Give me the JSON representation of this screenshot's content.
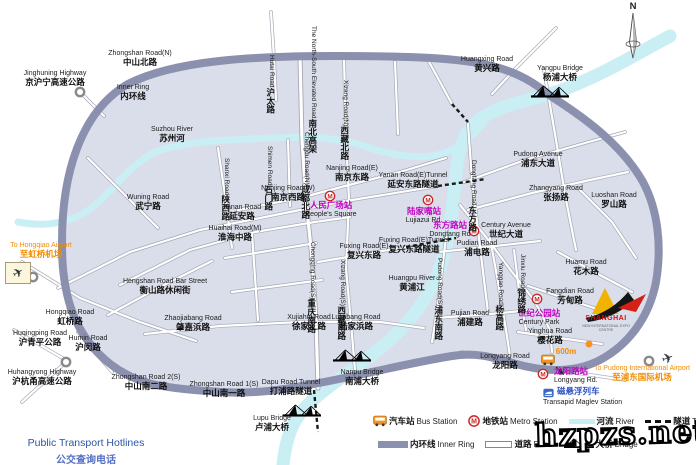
{
  "map": {
    "compass": "N",
    "colors": {
      "inner_ring": "#8b90ae",
      "river": "#c9eef4",
      "map_fill": "#dadeea",
      "station_text": "#c400c4",
      "airport_text": "#f08c00",
      "maglev_text": "#2f55c0",
      "metro_icon": "#c62828",
      "bus_icon": "#f7941d",
      "hotlines_text": "#2b55a8"
    },
    "labels": [
      {
        "id": "lbl-jinghuning-highway",
        "en": "Jinghuning Highway",
        "zh": "京沪宁高速公路",
        "x": 55,
        "y": 70
      },
      {
        "id": "lbl-zhongshan-road-n",
        "en": "Zhongshan Road(N)",
        "zh": "中山北路",
        "x": 140,
        "y": 50
      },
      {
        "id": "lbl-inner-ring",
        "en": "Inner Ring",
        "zh": "内环线",
        "x": 133,
        "y": 84
      },
      {
        "id": "lbl-hutai-road",
        "en": "Hutai Road",
        "zh": "沪太路",
        "x": 262,
        "y": 55,
        "cls": "v"
      },
      {
        "id": "lbl-north-south-elevated",
        "en": "The North-South Elevated Road",
        "zh": "南北高架",
        "x": 304,
        "y": 26,
        "cls": "v"
      },
      {
        "id": "lbl-xizang-road-n",
        "en": "Xizang Road(N)",
        "zh": "西藏北路",
        "x": 336,
        "y": 80,
        "cls": "v"
      },
      {
        "id": "lbl-huangxing-road",
        "en": "Huangxing Road",
        "zh": "黄兴路",
        "x": 487,
        "y": 56
      },
      {
        "id": "lbl-yangpu-bridge",
        "en": "Yangpu Bridge",
        "zh": "杨浦大桥",
        "x": 560,
        "y": 65
      },
      {
        "id": "lbl-suzhou-river",
        "en": "Suzhou River",
        "zh": "苏州河",
        "x": 172,
        "y": 126
      },
      {
        "id": "lbl-shimen-road",
        "en": "Shimen Road",
        "zh": "石门路",
        "x": 260,
        "y": 146,
        "cls": "v"
      },
      {
        "id": "lbl-chengdu-road-n",
        "en": "Chengdu Road(N)",
        "zh": "成都北路",
        "x": 297,
        "y": 132,
        "cls": "v"
      },
      {
        "id": "lbl-nanjing-road-e",
        "en": "Nanjing Road(E)",
        "zh": "南京东路",
        "x": 352,
        "y": 165
      },
      {
        "id": "lbl-yanan-road-e-tunnel",
        "en": "Yanan Road(E)Tunnel",
        "zh": "延安东路隧道",
        "x": 413,
        "y": 172
      },
      {
        "id": "lbl-pudong-avenue",
        "en": "Pudong Avenue",
        "zh": "浦东大道",
        "x": 538,
        "y": 151
      },
      {
        "id": "lbl-dongfang-road-v",
        "en": "Dongfang Road",
        "zh": "东方路",
        "x": 464,
        "y": 160,
        "cls": "v"
      },
      {
        "id": "lbl-zhangyang-road",
        "en": "Zhangyang Road",
        "zh": "张扬路",
        "x": 556,
        "y": 185
      },
      {
        "id": "lbl-luoshan-road",
        "en": "Luoshan Road",
        "zh": "罗山路",
        "x": 614,
        "y": 192
      },
      {
        "id": "lbl-wuning-road",
        "en": "Wuning Road",
        "zh": "武宁路",
        "x": 148,
        "y": 194
      },
      {
        "id": "lbl-shanxi-road",
        "en": "Shanxi Road",
        "zh": "陕西路",
        "x": 217,
        "y": 158,
        "cls": "v"
      },
      {
        "id": "lbl-nanjing-road-w",
        "en": "Nanjing Road(W)",
        "zh": "南京西路",
        "x": 288,
        "y": 185
      },
      {
        "id": "lbl-peoples-square",
        "zh": "人民广场站",
        "en": "People's Square",
        "x": 331,
        "y": 201,
        "cls": "station",
        "first": "zh"
      },
      {
        "id": "lbl-lujiazui-station",
        "zh": "陆家嘴站",
        "en": "Lujiazui Rd.",
        "x": 424,
        "y": 207,
        "cls": "station",
        "first": "zh"
      },
      {
        "id": "lbl-dongfang-rd-station",
        "zh": "东方路站",
        "en": "Dongfang Rd",
        "x": 450,
        "y": 221,
        "cls": "station",
        "first": "zh"
      },
      {
        "id": "lbl-century-avenue",
        "en": "Century Avenue",
        "zh": "世纪大道",
        "x": 506,
        "y": 222
      },
      {
        "id": "lbl-yanan-road",
        "en": "Yanan Road",
        "zh": "延安路",
        "x": 242,
        "y": 204
      },
      {
        "id": "lbl-huaihai-road-m",
        "en": "Huaihai Road(M)",
        "zh": "淮海中路",
        "x": 235,
        "y": 225
      },
      {
        "id": "lbl-to-hongqiao-airport",
        "en": "To Hongqiao Airport",
        "zh": "至虹桥机场",
        "x": 41,
        "y": 242,
        "cls": "airport"
      },
      {
        "id": "lbl-hengshan-road-bar-street",
        "en": "Hengshan Road Bar Street",
        "zh": "衡山路休闲街",
        "x": 165,
        "y": 278
      },
      {
        "id": "lbl-chongqing-road-s",
        "en": "Chongqing Road(S)",
        "zh": "重庆南路",
        "x": 303,
        "y": 242,
        "cls": "v"
      },
      {
        "id": "lbl-xizang-road-s",
        "en": "Xizang Road(S)",
        "zh": "西藏南路",
        "x": 333,
        "y": 260,
        "cls": "v"
      },
      {
        "id": "lbl-fuxing-road-e",
        "en": "Fuxing Road(E)",
        "zh": "复兴东路",
        "x": 364,
        "y": 243
      },
      {
        "id": "lbl-fuxing-road-e-tunnel",
        "en": "Fuxing Road(E)Tunnel",
        "zh": "复兴东路隧道",
        "x": 414,
        "y": 237
      },
      {
        "id": "lbl-huangpu-river",
        "en": "Huangpu River",
        "zh": "黄浦江",
        "x": 412,
        "y": 275
      },
      {
        "id": "lbl-pudong-road-s",
        "en": "Pudong Road(S)",
        "zh": "浦东南路",
        "x": 430,
        "y": 258,
        "cls": "v"
      },
      {
        "id": "lbl-pudian-road",
        "en": "Pudian Road",
        "zh": "浦电路",
        "x": 477,
        "y": 240
      },
      {
        "id": "lbl-pujian-road",
        "en": "Pujian Road",
        "zh": "浦建路",
        "x": 470,
        "y": 310
      },
      {
        "id": "lbl-hongqiao-road",
        "en": "Hongqiao Road",
        "zh": "虹桥路",
        "x": 70,
        "y": 309
      },
      {
        "id": "lbl-zhaojiabang-road",
        "en": "Zhaojiabang Road",
        "zh": "肇嘉浜路",
        "x": 193,
        "y": 315
      },
      {
        "id": "lbl-xujiahui-road",
        "en": "Xujiahui Road",
        "zh": "徐家汇路",
        "x": 309,
        "y": 314
      },
      {
        "id": "lbl-lujiabang-road",
        "en": "Lujiabang Road",
        "zh": "陆家浜路",
        "x": 356,
        "y": 314
      },
      {
        "id": "lbl-huqingping-road",
        "en": "Huqingping Road",
        "zh": "沪青平公路",
        "x": 40,
        "y": 330
      },
      {
        "id": "lbl-humin-road",
        "en": "Humin Road",
        "zh": "沪闵路",
        "x": 88,
        "y": 335
      },
      {
        "id": "lbl-huhangyong-highway",
        "en": "Huhangyong Highway",
        "zh": "沪杭甬高速公路",
        "x": 42,
        "y": 369
      },
      {
        "id": "lbl-zhongshan-road-2s",
        "en": "Zhongshan Road 2(S)",
        "zh": "中山南二路",
        "x": 146,
        "y": 374
      },
      {
        "id": "lbl-zhongshan-road-1s",
        "en": "Zhongshan Road 1(S)",
        "zh": "中山南一路",
        "x": 224,
        "y": 381
      },
      {
        "id": "lbl-dapu-road-tunnel",
        "en": "Dapu Road Tunnel",
        "zh": "打浦路隧道",
        "x": 291,
        "y": 379
      },
      {
        "id": "lbl-nanpu-bridge",
        "en": "Nanpu Bridge",
        "zh": "南浦大桥",
        "x": 362,
        "y": 369
      },
      {
        "id": "lbl-lupu-bridge",
        "en": "Lupu Bridge",
        "zh": "卢浦大桥",
        "x": 272,
        "y": 415
      },
      {
        "id": "lbl-longyang-road",
        "en": "Longyang Road",
        "zh": "龙阳路",
        "x": 505,
        "y": 353
      },
      {
        "id": "lbl-longyang-rd-station",
        "zh": "龙阳路站",
        "en": "Longyang Rd.",
        "x": 554,
        "y": 367,
        "cls": "station la",
        "first": "zh"
      },
      {
        "id": "lbl-maglev-zh",
        "zh": "磁悬浮列车",
        "x": 557,
        "y": 387,
        "cls": "maglev la"
      },
      {
        "id": "lbl-maglev-en",
        "en": "Transapid Maglev Station",
        "x": 543,
        "y": 399,
        "cls": "la"
      },
      {
        "id": "lbl-to-pudong-airport",
        "en": "To Pudong International Airport",
        "zh": "至浦东国际机场",
        "x": 642,
        "y": 365,
        "cls": "airport"
      },
      {
        "id": "lbl-huamu-road",
        "en": "Huamu Road",
        "zh": "花木路",
        "x": 586,
        "y": 259
      },
      {
        "id": "lbl-fangdian-road",
        "en": "Fangdian Road",
        "zh": "芳甸路",
        "x": 570,
        "y": 288
      },
      {
        "id": "lbl-century-park-station",
        "zh": "世纪公园站",
        "en": "Century Park",
        "x": 539,
        "y": 309,
        "cls": "station",
        "first": "zh"
      },
      {
        "id": "lbl-yinghua-road",
        "en": "Yinghua Road",
        "zh": "樱花路",
        "x": 550,
        "y": 328
      },
      {
        "id": "lbl-yanggao-road",
        "en": "Yanggao Road",
        "zh": "杨高路",
        "x": 491,
        "y": 262,
        "cls": "v"
      },
      {
        "id": "lbl-jinxiu-road",
        "en": "Jinxiu Road",
        "zh": "锦绣路",
        "x": 513,
        "y": 254,
        "cls": "v"
      },
      {
        "id": "lbl-600m",
        "en": "600m",
        "x": 566,
        "y": 348,
        "cls": "m600"
      },
      {
        "id": "lbl-compass-n",
        "en": "N",
        "x": 633,
        "y": 2,
        "cls": "compass"
      },
      {
        "id": "lbl-expo-name",
        "en": "SHANGHAI",
        "x": 606,
        "y": 315,
        "cls": "expo-name"
      },
      {
        "id": "lbl-expo-sub",
        "en": "NEW INTERNATIONAL EXPO CENTRE",
        "x": 606,
        "y": 324,
        "cls": "expo-sub"
      }
    ],
    "legend": {
      "row1": [
        {
          "icon": "bus",
          "zh": "汽车站",
          "en": "Bus Station"
        },
        {
          "icon": "metro",
          "zh": "地铁站",
          "en": "Metro Station"
        },
        {
          "icon": "river",
          "zh": "河流",
          "en": "River"
        },
        {
          "icon": "tunnel",
          "zh": "隧道",
          "en": "Tunnel"
        }
      ],
      "row2": [
        {
          "icon": "ring",
          "zh": "内环线",
          "en": "Inner Ring"
        },
        {
          "icon": "road",
          "zh": "道路",
          "en": "Road"
        },
        {
          "icon": "bridge",
          "zh": "大桥",
          "en": "Bridge"
        }
      ]
    },
    "hotlines": {
      "en": "Public Transport Hotlines",
      "zh": "公交查询电话"
    },
    "watermark": "hzpzs.net"
  }
}
